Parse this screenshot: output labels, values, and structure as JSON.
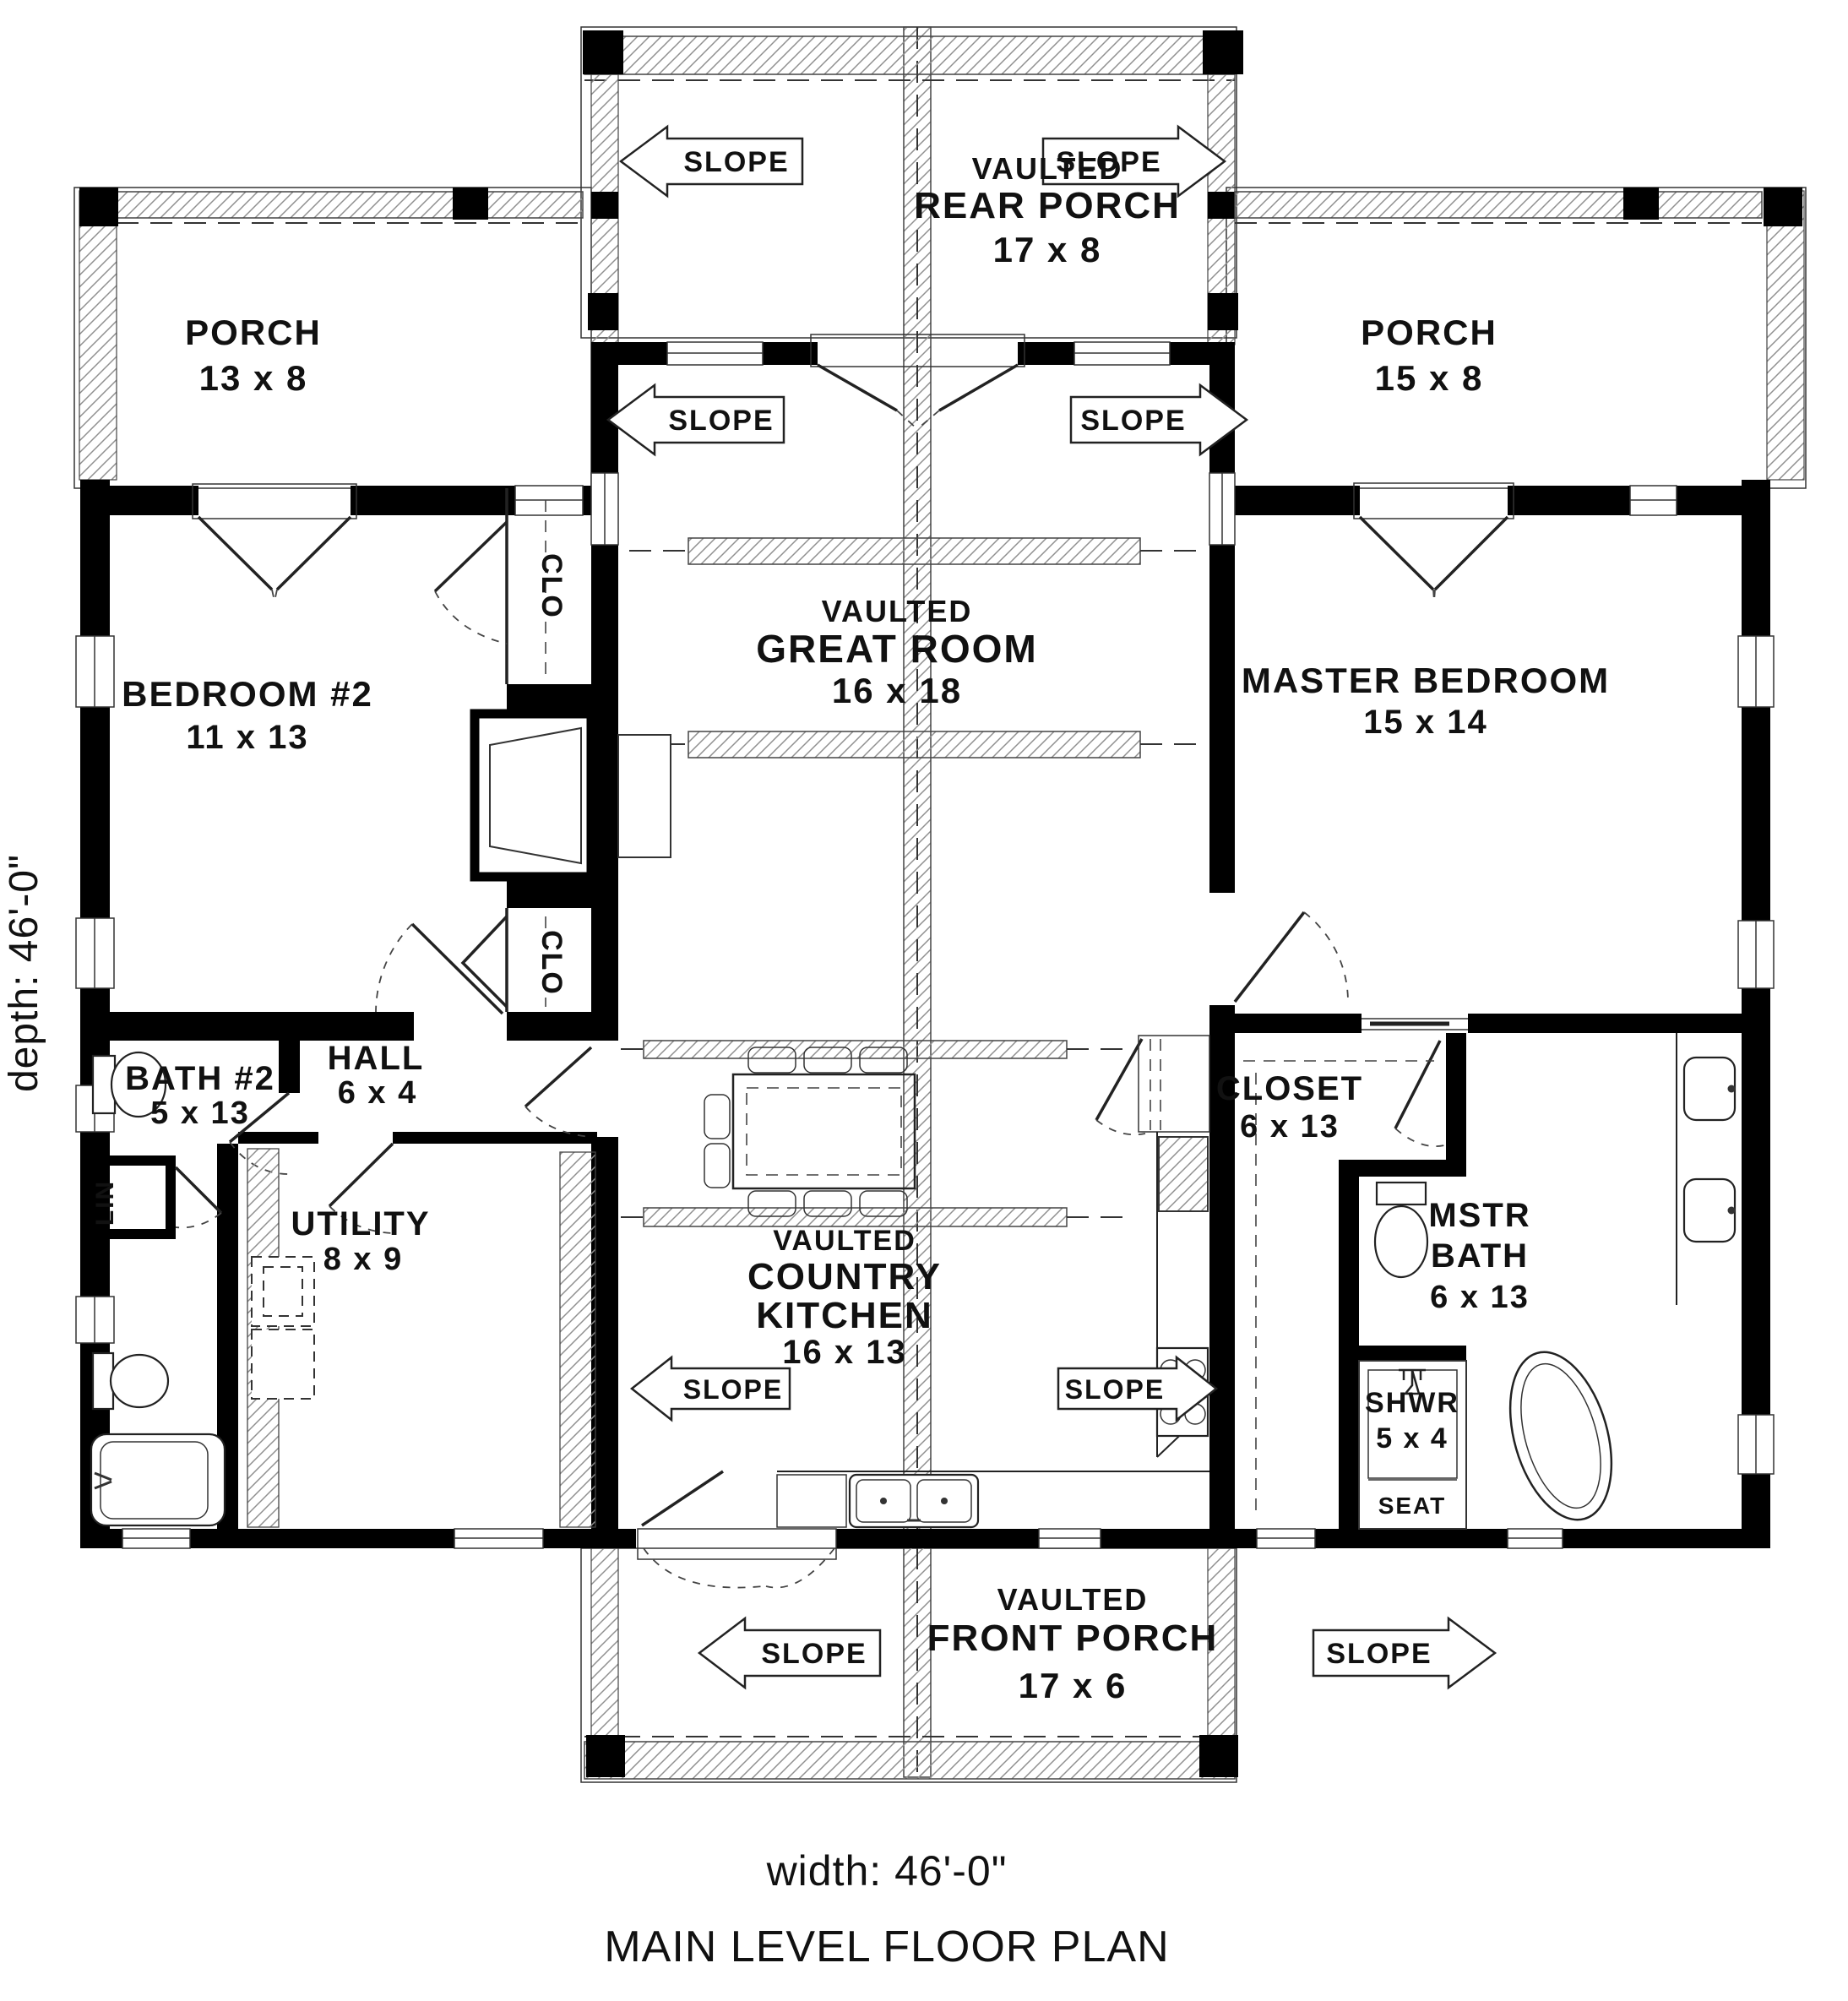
{
  "ink": "#111111",
  "paper": "#ffffff",
  "hatch_color": "#8f8f8f",
  "slope": "SLOPE",
  "footer": {
    "width_label": "width: 46'-0\"",
    "plan_title": "MAIN LEVEL FLOOR PLAN"
  },
  "side": {
    "depth_label": "depth: 46'-0\""
  },
  "rooms": {
    "rear_porch": {
      "line1": "VAULTED",
      "line2": "REAR PORCH",
      "dims": "17 x 8"
    },
    "front_porch": {
      "line1": "VAULTED",
      "line2": "FRONT PORCH",
      "dims": "17 x 6"
    },
    "porch_left": {
      "name": "PORCH",
      "dims": "13 x 8"
    },
    "porch_right": {
      "name": "PORCH",
      "dims": "15 x 8"
    },
    "great_room": {
      "line1": "VAULTED",
      "line2": "GREAT ROOM",
      "dims": "16 x 18"
    },
    "kitchen": {
      "line1": "VAULTED",
      "line2": "COUNTRY",
      "line3": "KITCHEN",
      "dims": "16 x 13"
    },
    "bedroom2": {
      "name": "BEDROOM #2",
      "dims": "11 x 13"
    },
    "master_bedroom": {
      "name": "MASTER BEDROOM",
      "dims": "15 x 14"
    },
    "bath2": {
      "name": "BATH #2",
      "dims": "5 x 13"
    },
    "hall": {
      "name": "HALL",
      "dims": "6 x 4"
    },
    "utility": {
      "name": "UTILITY",
      "dims": "8 x 9"
    },
    "closet": {
      "name": "CLOSET",
      "dims": "6 x 13"
    },
    "master_bath": {
      "line1": "MSTR",
      "line2": "BATH",
      "dims": "6 x 13"
    },
    "shower": {
      "name": "SHWR",
      "dims": "5 x 4",
      "seat": "SEAT"
    },
    "clo": "CLO",
    "lin": "LIN"
  }
}
